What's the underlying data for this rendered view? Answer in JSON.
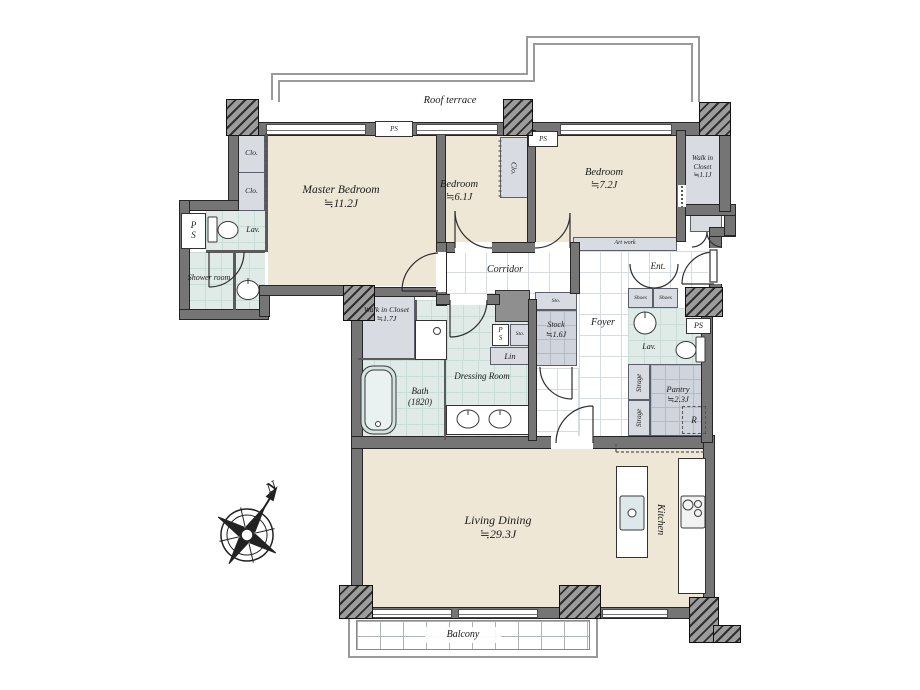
{
  "plan": {
    "outdoor": {
      "roof_terrace": "Roof terrace",
      "balcony": "Balcony"
    },
    "compass": {
      "north": "N"
    },
    "rooms": {
      "master_bedroom": {
        "name": "Master Bedroom",
        "size": "≒11.2J"
      },
      "bedroom_6": {
        "name": "Bedroom",
        "size": "≒6.1J"
      },
      "bedroom_7": {
        "name": "Bedroom",
        "size": "≒7.2J"
      },
      "walk_in_closet_small": {
        "name": "Walk in Closet",
        "size": "≒1.1J"
      },
      "walk_in_closet_large": {
        "name": "Walk in Closet",
        "size": "≒1.7J"
      },
      "corridor": {
        "name": "Corridor"
      },
      "foyer": {
        "name": "Foyer"
      },
      "entrance": {
        "name": "Ent."
      },
      "dressing_room": {
        "name": "Dressing Room"
      },
      "bath": {
        "name": "Bath",
        "size": "(1820)"
      },
      "shower_room": {
        "name": "Shower room"
      },
      "stock": {
        "name": "Stock",
        "size": "≒1.6J"
      },
      "pantry": {
        "name": "Pantry",
        "size": "≒2.3J"
      },
      "living_dining": {
        "name": "Living Dining",
        "size": "≒29.3J"
      },
      "kitchen": {
        "name": "Kitchen"
      }
    },
    "fixtures": {
      "lavatory": "Lav.",
      "closet": "Clo.",
      "pipe_space": "PS",
      "p": "P",
      "s": "S",
      "storage_small": "Sto.",
      "linen": "Lin",
      "shoes": "Shoes",
      "storage": "Strage",
      "refrigerator": "R",
      "art_work": "Art work"
    },
    "colors": {
      "wall": "#757575",
      "floor": "#efe7d6",
      "wet_area": "#e0eae6",
      "closet": "#d8dbe2",
      "tile_line": "#d5dbde",
      "line_dark": "#2e2e2e"
    }
  }
}
